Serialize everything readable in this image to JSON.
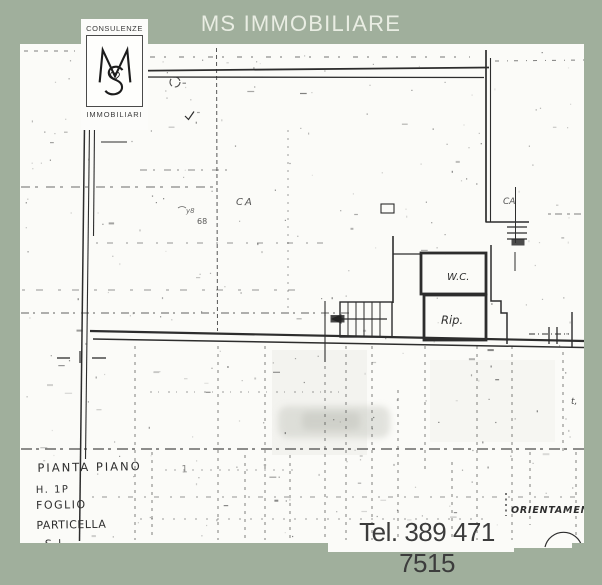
{
  "header": {
    "title": "MS IMMOBILIARE"
  },
  "logo": {
    "line_top": "CONSULENZE",
    "monogram": "MS",
    "line_bottom": "IMMOBILIARI"
  },
  "footer": {
    "phone": "Tel. 389 471 7515"
  },
  "colors": {
    "frame_green": "#a0af9c",
    "paper_white": "#fbfbf8",
    "ink": "#2e2e2e",
    "title_text": "#e9ede3",
    "phone_text": "#3c3c3c"
  },
  "plan": {
    "room_labels": {
      "wc": "W.C.",
      "rip": "Rip."
    },
    "handwriting": {
      "line1": "PIANTA PIANO",
      "line1_mark": "1",
      "line2": "H. 1P",
      "line3": "FOGLIO",
      "line4": "PARTICELLA",
      "line5": "S l"
    },
    "compass_label": "ORIENTAMEN",
    "tiny_marks": {
      "ca1": "CA",
      "ca2": "CA",
      "n68": "68",
      "y8": "y8",
      "t": "t,"
    }
  }
}
